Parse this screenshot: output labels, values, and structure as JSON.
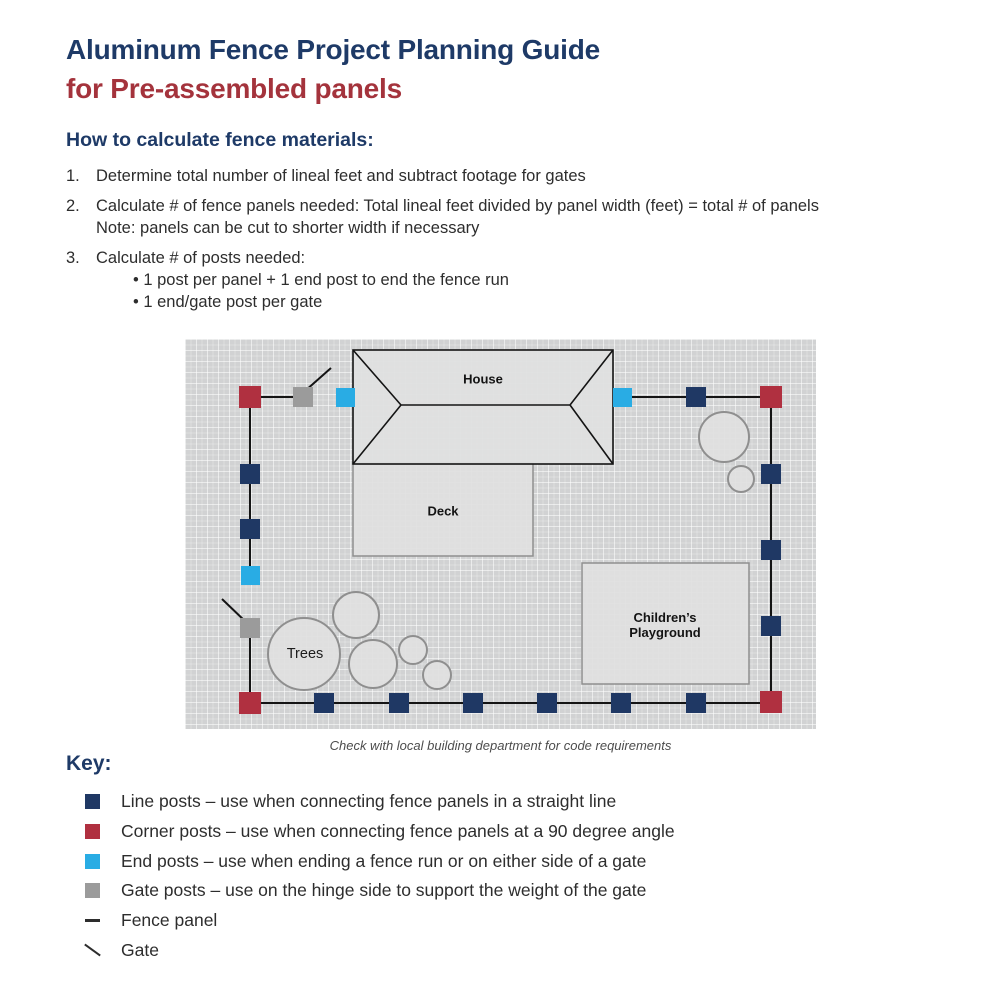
{
  "page": {
    "title_line1": "Aluminum Fence Project Planning Guide",
    "title_line2": "for Pre-assembled panels",
    "section_heading": "How to calculate fence materials:",
    "steps": [
      {
        "num": "1.",
        "text": "Determine total number of lineal feet and subtract footage for gates"
      },
      {
        "num": "2.",
        "text": "Calculate # of fence panels needed: Total lineal feet divided by panel width (feet) = total # of panels",
        "note": "Note: panels can be cut to shorter width if necessary"
      },
      {
        "num": "3.",
        "text": "Calculate # of posts needed:",
        "bullets": [
          "1 post per panel + 1 end post to end the fence run",
          "1 end/gate post per gate"
        ]
      }
    ]
  },
  "diagram": {
    "caption": "Check with local building department for code requirements",
    "labels": {
      "house": "House",
      "deck": "Deck",
      "trees": "Trees",
      "playground_line1": "Children’s",
      "playground_line2": "Playground"
    },
    "posts": [
      {
        "type": "corner",
        "x": 65,
        "y": 58
      },
      {
        "type": "gate",
        "x": 118,
        "y": 58
      },
      {
        "type": "end",
        "x": 160,
        "y": 58
      },
      {
        "type": "end",
        "x": 437,
        "y": 58
      },
      {
        "type": "line",
        "x": 511,
        "y": 58
      },
      {
        "type": "corner",
        "x": 586,
        "y": 58
      },
      {
        "type": "line",
        "x": 65,
        "y": 135
      },
      {
        "type": "line",
        "x": 65,
        "y": 190
      },
      {
        "type": "end",
        "x": 65,
        "y": 236
      },
      {
        "type": "gate",
        "x": 65,
        "y": 289
      },
      {
        "type": "corner",
        "x": 65,
        "y": 364
      },
      {
        "type": "line",
        "x": 586,
        "y": 135
      },
      {
        "type": "line",
        "x": 586,
        "y": 211
      },
      {
        "type": "line",
        "x": 586,
        "y": 287
      },
      {
        "type": "corner",
        "x": 586,
        "y": 363
      },
      {
        "type": "line",
        "x": 139,
        "y": 364
      },
      {
        "type": "line",
        "x": 214,
        "y": 364
      },
      {
        "type": "line",
        "x": 288,
        "y": 364
      },
      {
        "type": "line",
        "x": 362,
        "y": 364
      },
      {
        "type": "line",
        "x": 436,
        "y": 364
      },
      {
        "type": "line",
        "x": 511,
        "y": 364
      }
    ],
    "fence_lines": [
      [
        65,
        58,
        118,
        58
      ],
      [
        437,
        58,
        586,
        58
      ],
      [
        65,
        58,
        65,
        236
      ],
      [
        65,
        289,
        65,
        364
      ],
      [
        586,
        58,
        586,
        363
      ],
      [
        65,
        364,
        586,
        364
      ]
    ],
    "gates": [
      [
        120,
        52,
        146,
        29
      ],
      [
        62,
        284,
        37,
        260
      ]
    ],
    "trees": [
      {
        "cx": 119,
        "cy": 315,
        "r": 36
      },
      {
        "cx": 171,
        "cy": 276,
        "r": 23
      },
      {
        "cx": 188,
        "cy": 325,
        "r": 24
      },
      {
        "cx": 228,
        "cy": 311,
        "r": 14
      },
      {
        "cx": 252,
        "cy": 336,
        "r": 14
      },
      {
        "cx": 539,
        "cy": 98,
        "r": 25
      },
      {
        "cx": 556,
        "cy": 140,
        "r": 13
      }
    ]
  },
  "key": {
    "heading": "Key:",
    "items": [
      {
        "icon": "line-post",
        "label": "Line posts – use when connecting fence panels in a straight line"
      },
      {
        "icon": "corner-post",
        "label": "Corner posts – use when connecting fence panels at a 90 degree angle"
      },
      {
        "icon": "end-post",
        "label": "End posts – use when ending a fence run or on either side of a gate"
      },
      {
        "icon": "gate-post",
        "label": "Gate posts – use on the hinge side to support the weight of the gate"
      },
      {
        "icon": "fence-panel",
        "label": "Fence panel"
      },
      {
        "icon": "gate",
        "label": "Gate"
      }
    ]
  },
  "colors": {
    "title_navy": "#1e3a67",
    "title_red": "#a4333c",
    "line_post": "#1f3864",
    "corner_post": "#b03040",
    "end_post": "#29ace4",
    "gate_post": "#9b9b9b",
    "fence_line": "#141414"
  }
}
